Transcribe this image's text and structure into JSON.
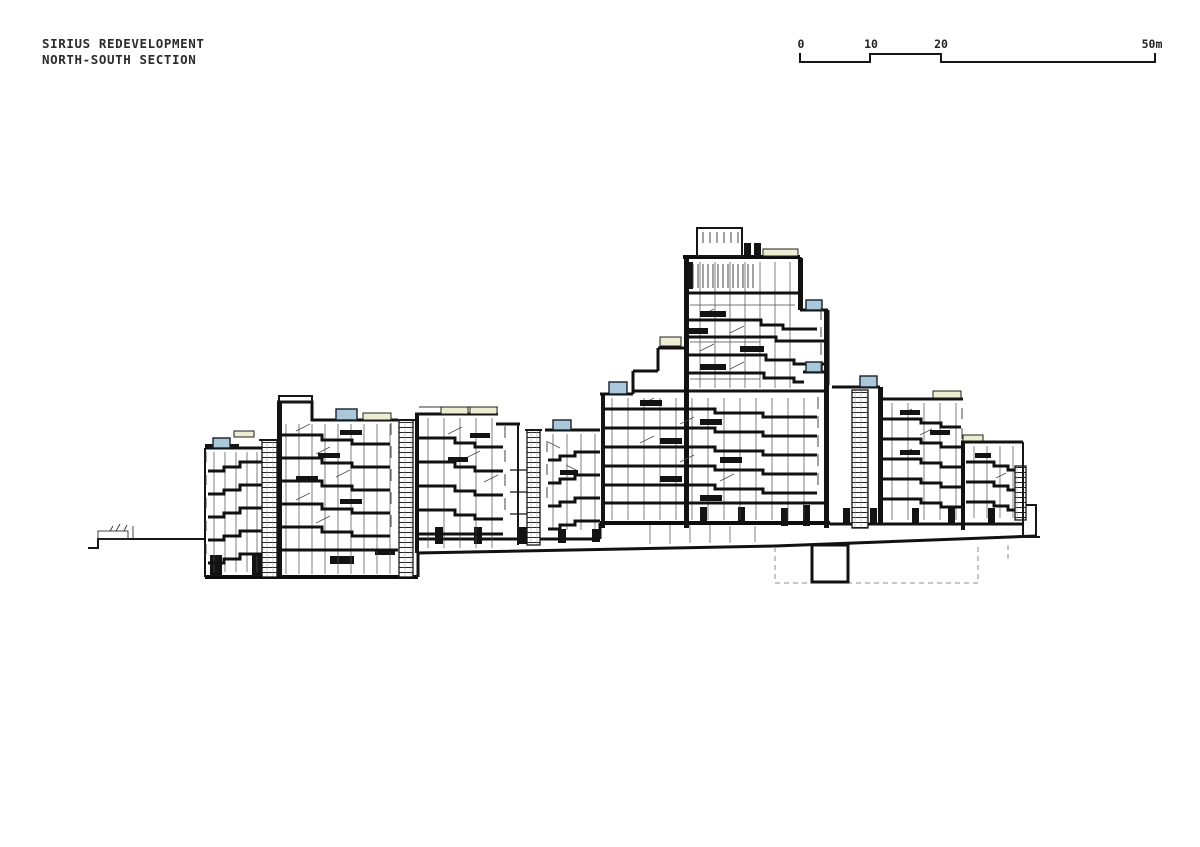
{
  "title": {
    "line1": "SIRIUS REDEVELOPMENT",
    "line2": "NORTH-SOUTH SECTION"
  },
  "scale_bar": {
    "unit": "m",
    "marks": [
      0,
      10,
      20,
      50
    ],
    "labels": {
      "m0": "0",
      "m10": "10",
      "m20": "20",
      "m50": "50m"
    }
  },
  "colors": {
    "paper": "#ffffff",
    "ink": "#161616",
    "fine_line": "#4a4a4a",
    "skylight_blue": "#aac8da",
    "planter_cream": "#ecedd2",
    "dashed_gray": "#8f8f8f"
  },
  "drawing": {
    "kind": "architectural cross-section",
    "features": {
      "skylights": 7,
      "roof_planters": 8,
      "stair_cores": 5,
      "basement": "dashed excavation outline with solid pit at right"
    }
  }
}
